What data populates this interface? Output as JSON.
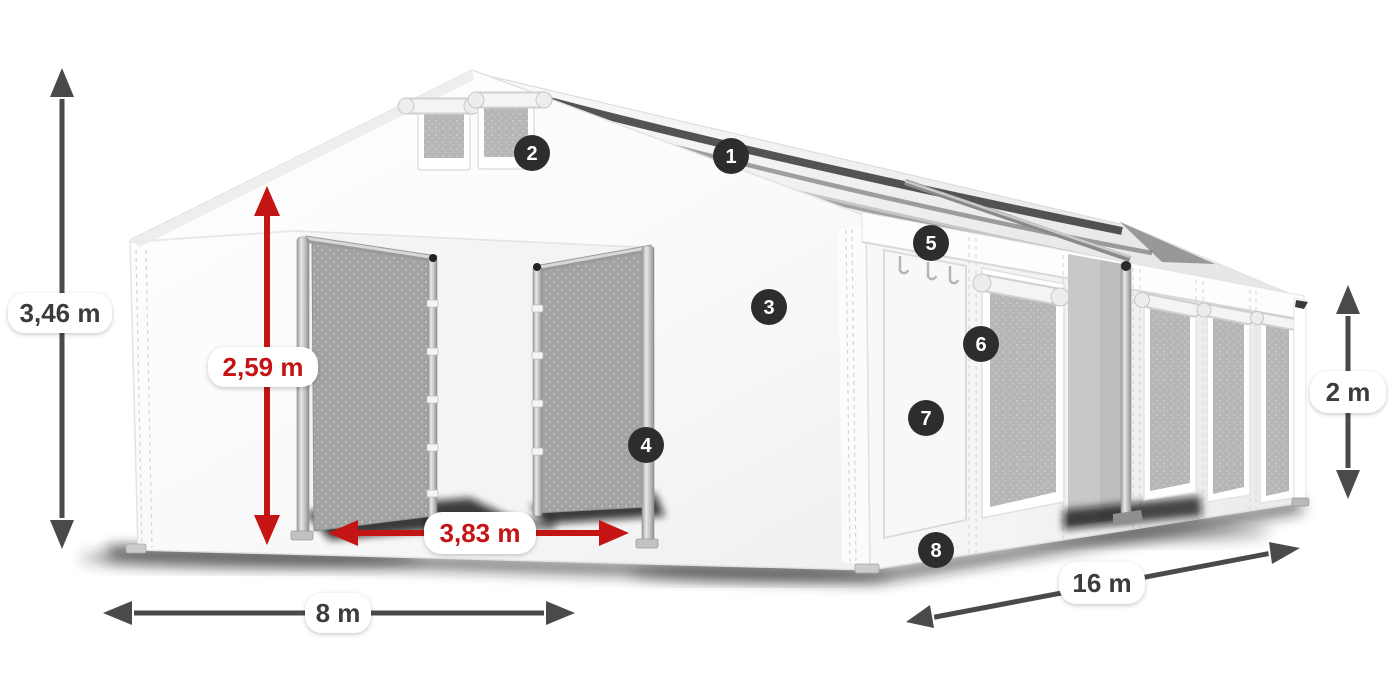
{
  "diagram": {
    "background": "#ffffff",
    "colors": {
      "badge_bg": "#2d2d2d",
      "badge_text": "#ffffff",
      "dimension_dark": "#4a4a4a",
      "dimension_red": "#c51414",
      "pill_bg": "#ffffff",
      "tent_white": "#fafafa",
      "mesh_gray": "#a8a8a8"
    }
  },
  "dimensions": [
    {
      "id": "total_height",
      "label": "3,46 m",
      "color": "dark",
      "orientation": "vertical"
    },
    {
      "id": "entrance_height",
      "label": "2,59 m",
      "color": "red",
      "orientation": "vertical"
    },
    {
      "id": "entrance_width",
      "label": "3,83 m",
      "color": "red",
      "orientation": "horizontal"
    },
    {
      "id": "front_width",
      "label": "8 m",
      "color": "dark",
      "orientation": "horizontal"
    },
    {
      "id": "side_length",
      "label": "16 m",
      "color": "dark",
      "orientation": "diagonal"
    },
    {
      "id": "side_height",
      "label": "2 m",
      "color": "dark",
      "orientation": "vertical"
    }
  ],
  "callouts": [
    {
      "number": "1"
    },
    {
      "number": "2"
    },
    {
      "number": "3"
    },
    {
      "number": "4"
    },
    {
      "number": "5"
    },
    {
      "number": "6"
    },
    {
      "number": "7"
    },
    {
      "number": "8"
    }
  ]
}
